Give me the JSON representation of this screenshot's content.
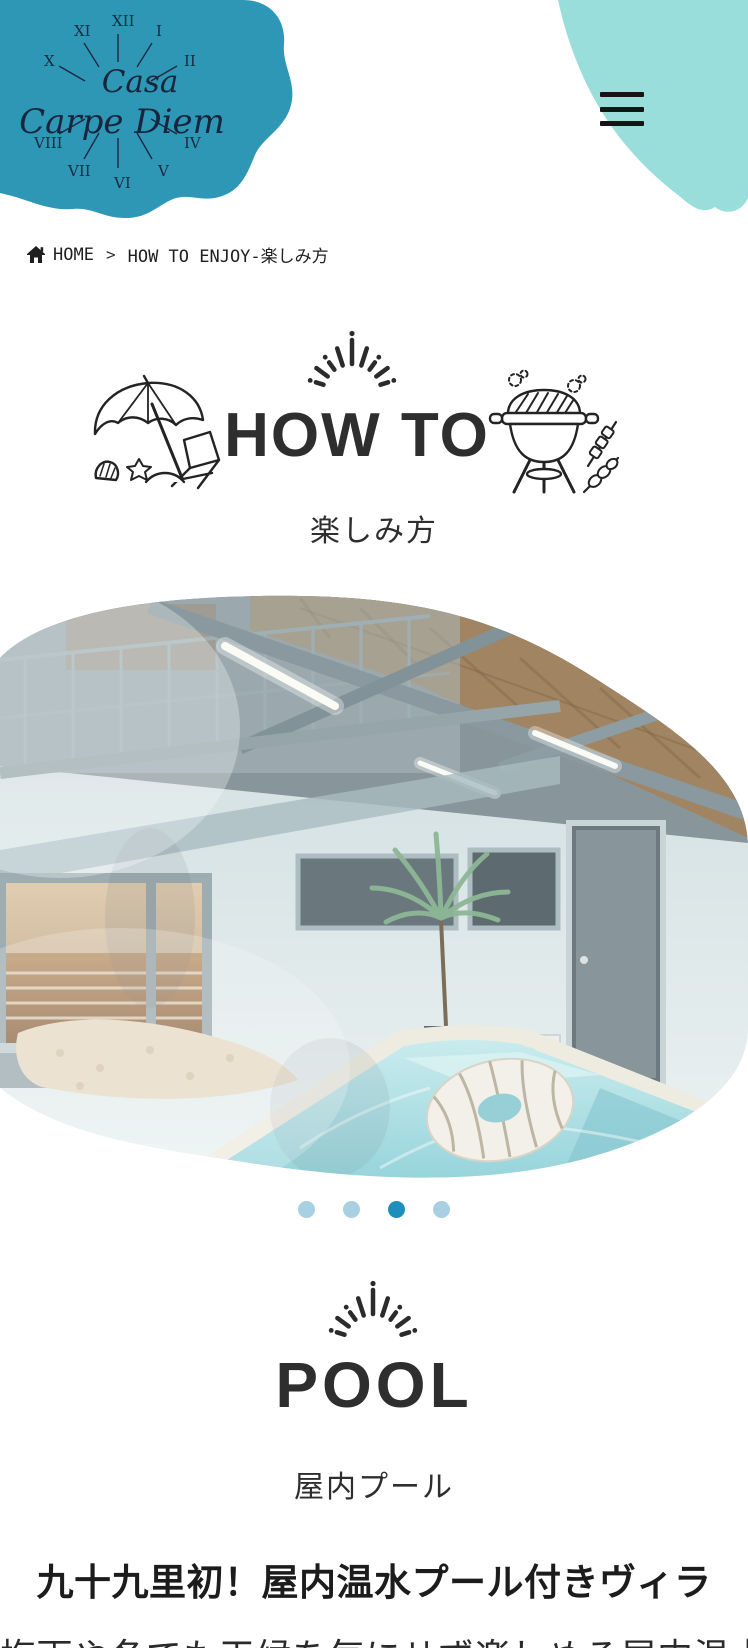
{
  "brand": {
    "name_line1": "Casa",
    "name_line2": "Carpe Diem",
    "clock_numerals": [
      "XII",
      "I",
      "II",
      "IV",
      "V",
      "VI",
      "VII",
      "VIII",
      "X",
      "XI"
    ]
  },
  "breadcrumb": {
    "home_label": "HOME",
    "separator": ">",
    "current": "HOW TO ENJOY-楽しみ方"
  },
  "sections": {
    "how_to": {
      "title": "HOW TO",
      "subtitle": "楽しみ方"
    },
    "pool": {
      "title": "POOL",
      "subtitle": "屋内プール",
      "headline": "九十九里初！屋内温水プール付きヴィラ",
      "body_preview": "梅雨や冬でも天候を気にせず楽しめる屋内温水プール"
    }
  },
  "carousel": {
    "dot_count": 4,
    "active_index": 2
  },
  "colors": {
    "brand_teal": "#2e97b6",
    "brand_teal_light": "#9adedb",
    "dot_inactive": "#a9cfe2",
    "dot_active": "#1e8fba",
    "heading_ink": "#2e2e2e"
  }
}
